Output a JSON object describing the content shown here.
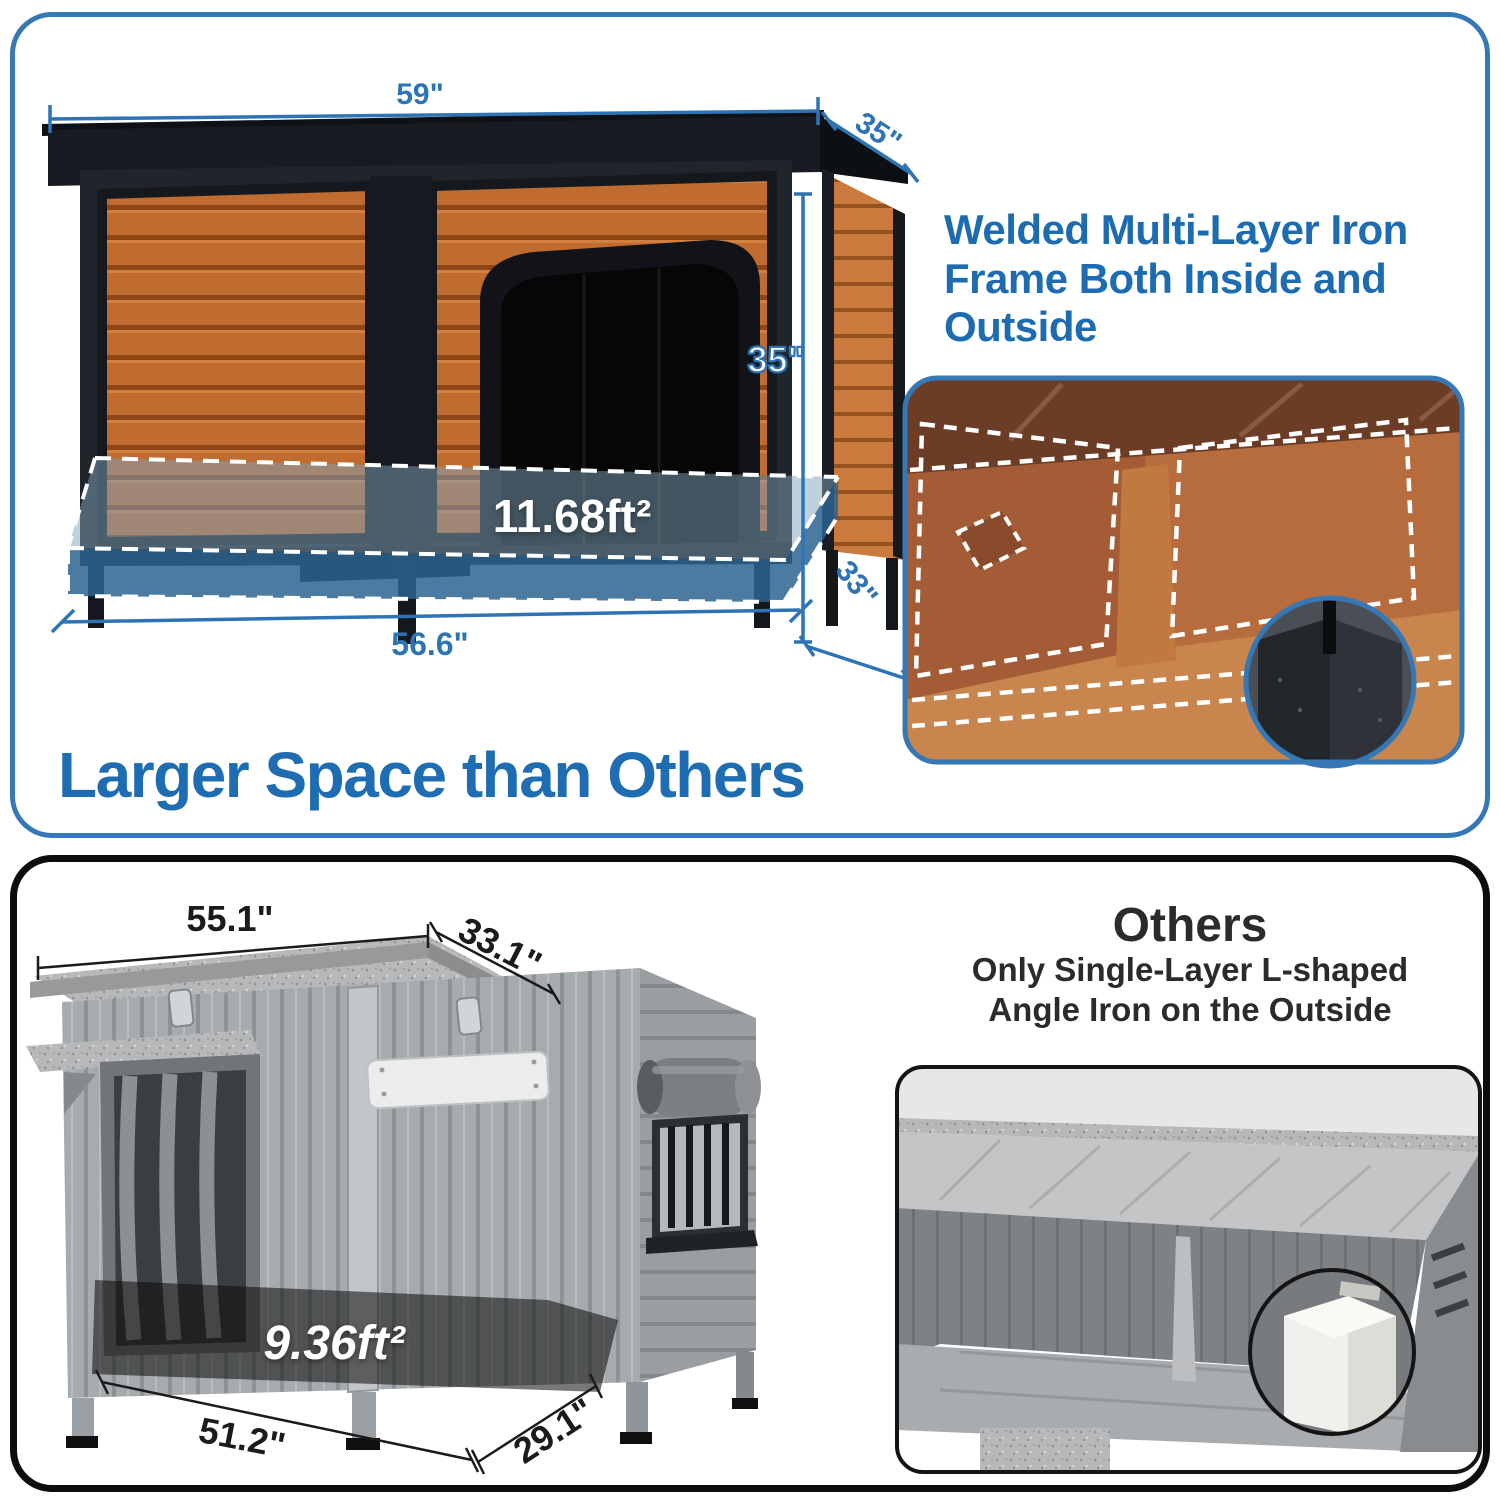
{
  "colors": {
    "accent_blue": "#2e74b5",
    "heading_blue": "#1e6cb2",
    "panel_border_blue": "#3578b5",
    "panel_border_black": "#0d0d0d",
    "wood_orange": "#c06b2f",
    "iron_black": "#17191e",
    "floor_overlay_blue": "#2d6491",
    "competitor_gray": "#a6abae"
  },
  "top_panel": {
    "dims": {
      "roof_width": "59\"",
      "roof_depth": "35\"",
      "height": "35\"",
      "floor_depth": "33\"",
      "floor_width": "56.6\""
    },
    "floor_area": "11.68ft²",
    "feature_heading_lines": [
      "Welded Multi-Layer Iron",
      "Frame Both Inside and",
      "Outside"
    ],
    "headline": "Larger Space than Others"
  },
  "bottom_panel": {
    "heading": "Others",
    "subheading_lines": [
      "Only Single-Layer L-shaped",
      "Angle Iron on the Outside"
    ],
    "dims": {
      "roof_width": "55.1\"",
      "roof_depth": "33.1\"",
      "floor_width": "51.2\"",
      "floor_depth": "29.1\""
    },
    "floor_area": "9.36ft²"
  }
}
